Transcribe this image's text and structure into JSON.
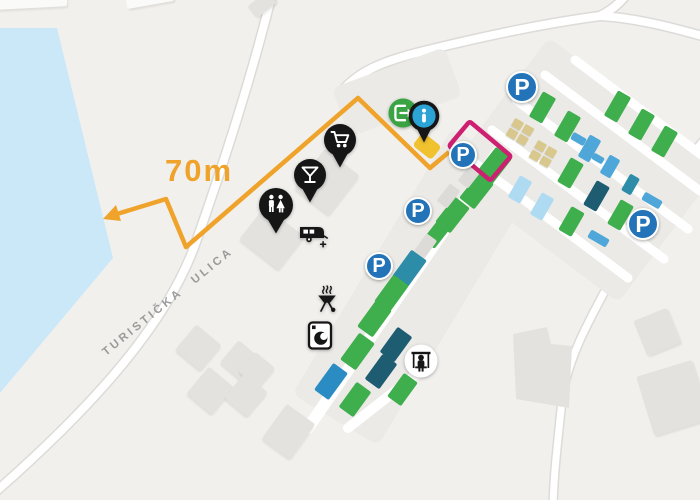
{
  "map": {
    "labels": {
      "distance": "70m",
      "street": "TURISTIČKA ULICA",
      "parking_letter": "P",
      "info_letter": "i"
    },
    "colors": {
      "bg": "#f1f0ed",
      "water": "#cbe8f8",
      "road_casing": "#dcdbd7",
      "road_fill": "#ffffff",
      "ground": "#ebeae7",
      "building": "#e3e2df",
      "building_light": "#fafaf8",
      "path_orange": "#efa32b",
      "marker_yellow": "#f1c22f",
      "highlight_pink": "#ce2071",
      "parking_blue": "#2273b8",
      "info_blue": "#2ba3d4",
      "entrance_green": "#3aa343",
      "pin_black": "#161616",
      "street_text": "#9a9a9a",
      "green": "#3fae4c",
      "teal": "#2d8ca8",
      "darkteal": "#1e5c72",
      "blue": "#2a8cc2",
      "bluebar": "#4fa6d8",
      "lightblue": "#aedaf2",
      "pitch_tan": "#d9c88e",
      "gray": "#dcdbd8"
    },
    "parking_markers": [
      {
        "x": 522,
        "y": 87,
        "r": 16
      },
      {
        "x": 463,
        "y": 155,
        "r": 14
      },
      {
        "x": 418,
        "y": 211,
        "r": 14
      },
      {
        "x": 379,
        "y": 266,
        "r": 14
      },
      {
        "x": 643,
        "y": 224,
        "r": 16
      }
    ],
    "amenities": {
      "supermarket-pin": {
        "x": 340,
        "y": 168
      },
      "bar-pin": {
        "x": 310,
        "y": 203
      },
      "toilets-pin": {
        "x": 276,
        "y": 234
      },
      "entrance-icon": {
        "x": 403,
        "y": 113
      },
      "info-pin": {
        "x": 424,
        "y": 143
      },
      "caravan-icon": {
        "x": 312,
        "y": 236
      },
      "bbq-icon": {
        "x": 327,
        "y": 300
      },
      "laundry-icon": {
        "x": 320,
        "y": 336
      },
      "playground-icon": {
        "x": 421,
        "y": 361
      }
    },
    "highlight": {
      "x": 480,
      "y": 151,
      "w": 54,
      "h": 32,
      "rot": 40
    },
    "route_marker": {
      "x": 427,
      "y": 146,
      "w": 24,
      "h": 17,
      "rot": 38
    },
    "pitches": [
      {
        "x": 493,
        "y": 167,
        "w": 20,
        "h": 36,
        "rot": 38,
        "c": "green"
      },
      {
        "x": 476,
        "y": 191,
        "w": 19,
        "h": 32,
        "rot": 38,
        "c": "green"
      },
      {
        "x": 452,
        "y": 215,
        "w": 19,
        "h": 32,
        "rot": 38,
        "c": "green"
      },
      {
        "x": 436,
        "y": 234,
        "w": 15,
        "h": 26,
        "rot": 38,
        "c": "green"
      },
      {
        "x": 409,
        "y": 268,
        "w": 19,
        "h": 33,
        "rot": 36,
        "c": "teal"
      },
      {
        "x": 391,
        "y": 293,
        "w": 19,
        "h": 33,
        "rot": 36,
        "c": "green"
      },
      {
        "x": 374,
        "y": 318,
        "w": 19,
        "h": 33,
        "rot": 36,
        "c": "green"
      },
      {
        "x": 357,
        "y": 351,
        "w": 19,
        "h": 33,
        "rot": 36,
        "c": "green"
      },
      {
        "x": 396,
        "y": 344,
        "w": 18,
        "h": 31,
        "rot": 36,
        "c": "darkteal"
      },
      {
        "x": 381,
        "y": 371,
        "w": 18,
        "h": 31,
        "rot": 36,
        "c": "darkteal"
      },
      {
        "x": 331,
        "y": 381,
        "w": 18,
        "h": 33,
        "rot": 36,
        "c": "blue"
      },
      {
        "x": 355,
        "y": 399,
        "w": 18,
        "h": 31,
        "rot": 36,
        "c": "green"
      },
      {
        "x": 402,
        "y": 389,
        "w": 17,
        "h": 29,
        "rot": 36,
        "c": "green"
      },
      {
        "x": 448,
        "y": 196,
        "w": 13,
        "h": 22,
        "rot": 38,
        "c": "gray"
      },
      {
        "x": 469,
        "y": 176,
        "w": 13,
        "h": 22,
        "rot": 38,
        "c": "gray"
      },
      {
        "x": 425,
        "y": 246,
        "w": 13,
        "h": 22,
        "rot": 36,
        "c": "gray"
      },
      {
        "x": 617,
        "y": 106,
        "w": 15,
        "h": 29,
        "rot": 30,
        "c": "green"
      },
      {
        "x": 641,
        "y": 124,
        "w": 15,
        "h": 29,
        "rot": 30,
        "c": "green"
      },
      {
        "x": 664,
        "y": 141,
        "w": 15,
        "h": 29,
        "rot": 30,
        "c": "green"
      },
      {
        "x": 542,
        "y": 107,
        "w": 15,
        "h": 29,
        "rot": 30,
        "c": "green"
      },
      {
        "x": 567,
        "y": 126,
        "w": 15,
        "h": 29,
        "rot": 30,
        "c": "green"
      },
      {
        "x": 589,
        "y": 148,
        "w": 13,
        "h": 25,
        "rot": 30,
        "c": "bluebar"
      },
      {
        "x": 578,
        "y": 139,
        "w": 15,
        "h": 8,
        "rot": 30,
        "c": "bluebar"
      },
      {
        "x": 610,
        "y": 166,
        "w": 12,
        "h": 21,
        "rot": 30,
        "c": "bluebar"
      },
      {
        "x": 598,
        "y": 158,
        "w": 12,
        "h": 7,
        "rot": 30,
        "c": "bluebar"
      },
      {
        "x": 630,
        "y": 184,
        "w": 11,
        "h": 19,
        "rot": 30,
        "c": "teal"
      },
      {
        "x": 652,
        "y": 200,
        "w": 20,
        "h": 9,
        "rot": 30,
        "c": "bluebar"
      },
      {
        "x": 570,
        "y": 173,
        "w": 15,
        "h": 28,
        "rot": 30,
        "c": "green"
      },
      {
        "x": 596,
        "y": 196,
        "w": 15,
        "h": 28,
        "rot": 30,
        "c": "darkteal"
      },
      {
        "x": 620,
        "y": 215,
        "w": 15,
        "h": 28,
        "rot": 30,
        "c": "green"
      },
      {
        "x": 520,
        "y": 189,
        "w": 14,
        "h": 25,
        "rot": 30,
        "c": "lightblue"
      },
      {
        "x": 542,
        "y": 206,
        "w": 14,
        "h": 25,
        "rot": 30,
        "c": "lightblue"
      },
      {
        "x": 571,
        "y": 221,
        "w": 15,
        "h": 27,
        "rot": 30,
        "c": "green"
      },
      {
        "x": 598,
        "y": 238,
        "w": 21,
        "h": 9,
        "rot": 30,
        "c": "bluebar"
      }
    ],
    "tan_blocks": [
      {
        "x": 520,
        "y": 132,
        "rot": 30
      },
      {
        "x": 543,
        "y": 154,
        "rot": 30
      }
    ],
    "buildings": [
      {
        "x": 272,
        "y": 238,
        "w": 50,
        "h": 42,
        "rot": 38
      },
      {
        "x": 327,
        "y": 182,
        "w": 44,
        "h": 50,
        "rot": 38
      },
      {
        "x": 198,
        "y": 347,
        "w": 33,
        "h": 33,
        "rot": 40
      },
      {
        "x": 240,
        "y": 360,
        "w": 29,
        "h": 29,
        "rot": 40
      },
      {
        "x": 257,
        "y": 370,
        "w": 26,
        "h": 26,
        "rot": 40
      },
      {
        "x": 210,
        "y": 390,
        "w": 33,
        "h": 35,
        "rot": 40
      },
      {
        "x": 246,
        "y": 395,
        "w": 30,
        "h": 32,
        "rot": 40
      },
      {
        "x": 288,
        "y": 431,
        "w": 35,
        "h": 43,
        "rot": 36
      },
      {
        "x": 657,
        "y": 332,
        "w": 36,
        "h": 38,
        "rot": -22
      },
      {
        "x": 673,
        "y": 398,
        "w": 58,
        "h": 62,
        "rot": -17
      },
      {
        "x": 262,
        "y": 4,
        "w": 26,
        "h": 15,
        "rot": -38
      },
      {
        "x": 32,
        "y": 1,
        "w": 70,
        "h": 14,
        "rot": -3,
        "c": "building_light"
      },
      {
        "x": 150,
        "y": -1,
        "w": 48,
        "h": 11,
        "rot": -10,
        "c": "building_light"
      }
    ]
  }
}
